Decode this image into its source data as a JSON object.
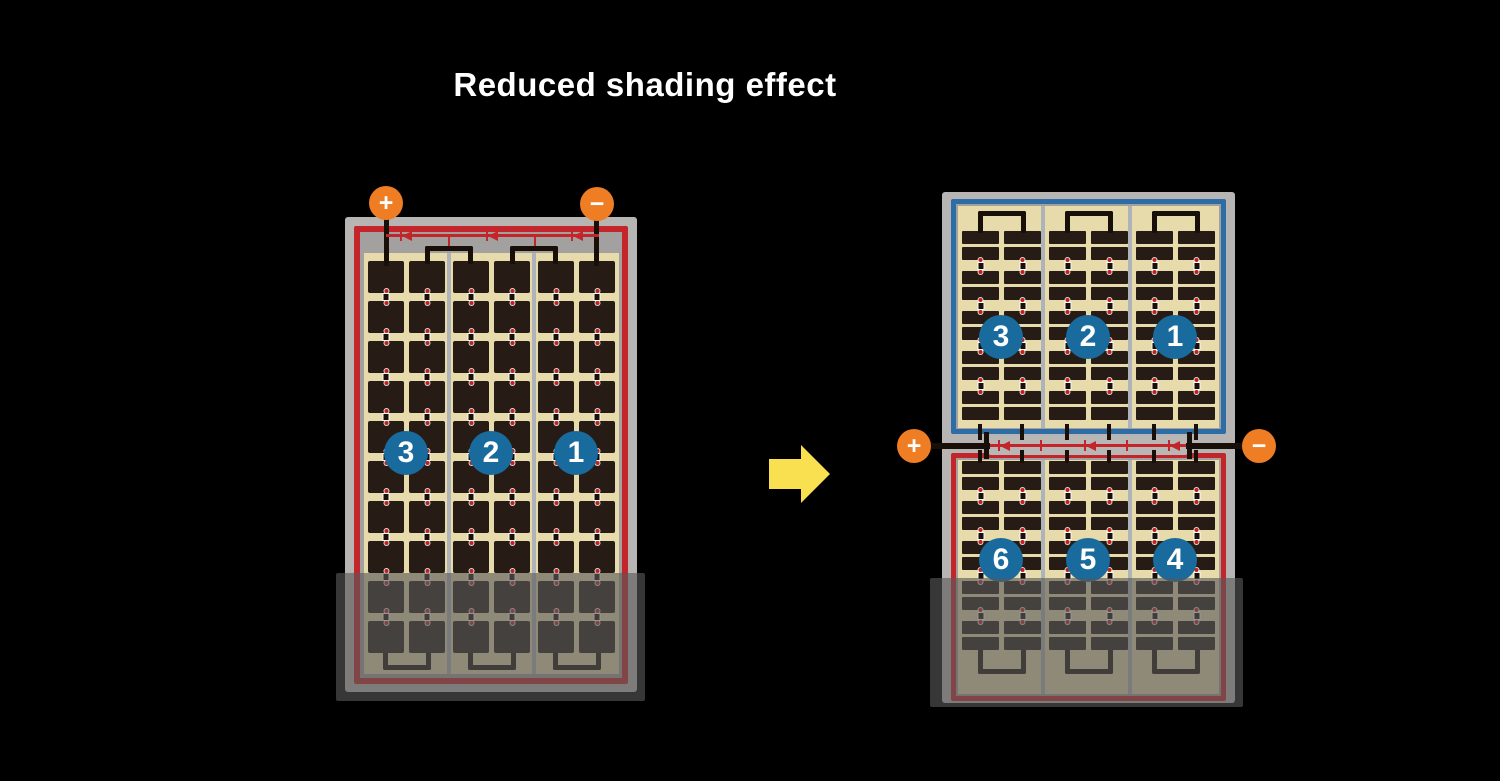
{
  "title": "Reduced shading effect",
  "colors": {
    "background": "#000000",
    "panel_frame": "#b7b5b3",
    "panel_inner_grey": "#a3a19f",
    "cell_field_tan": "#e7dbac",
    "cell_dark": "#261c15",
    "column_divider": "#adb3b9",
    "circuit_red": "#c3252a",
    "marker_red": "#c0211d",
    "border_blue": "#2d6ca4",
    "string_circle_blue": "#196b9e",
    "terminal_orange": "#ef7d24",
    "arrow_yellow": "#f8e051",
    "wire_black": "#181008",
    "shade_overlay": "rgba(88,88,88,0.62)"
  },
  "left_panel": {
    "terminal_plus": "+",
    "terminal_minus": "−",
    "string_numbers": [
      "3",
      "2",
      "1"
    ],
    "grid": {
      "groups": 3,
      "cols": 2,
      "rows": 10,
      "type": "full"
    }
  },
  "right_panel": {
    "terminal_plus": "+",
    "terminal_minus": "−",
    "top_string_numbers": [
      "3",
      "2",
      "1"
    ],
    "bottom_string_numbers": [
      "6",
      "5",
      "4"
    ],
    "top_grid": {
      "groups": 3,
      "cols": 2,
      "rows": 5,
      "type": "half"
    },
    "bottom_grid": {
      "groups": 3,
      "cols": 2,
      "rows": 5,
      "type": "half"
    }
  }
}
